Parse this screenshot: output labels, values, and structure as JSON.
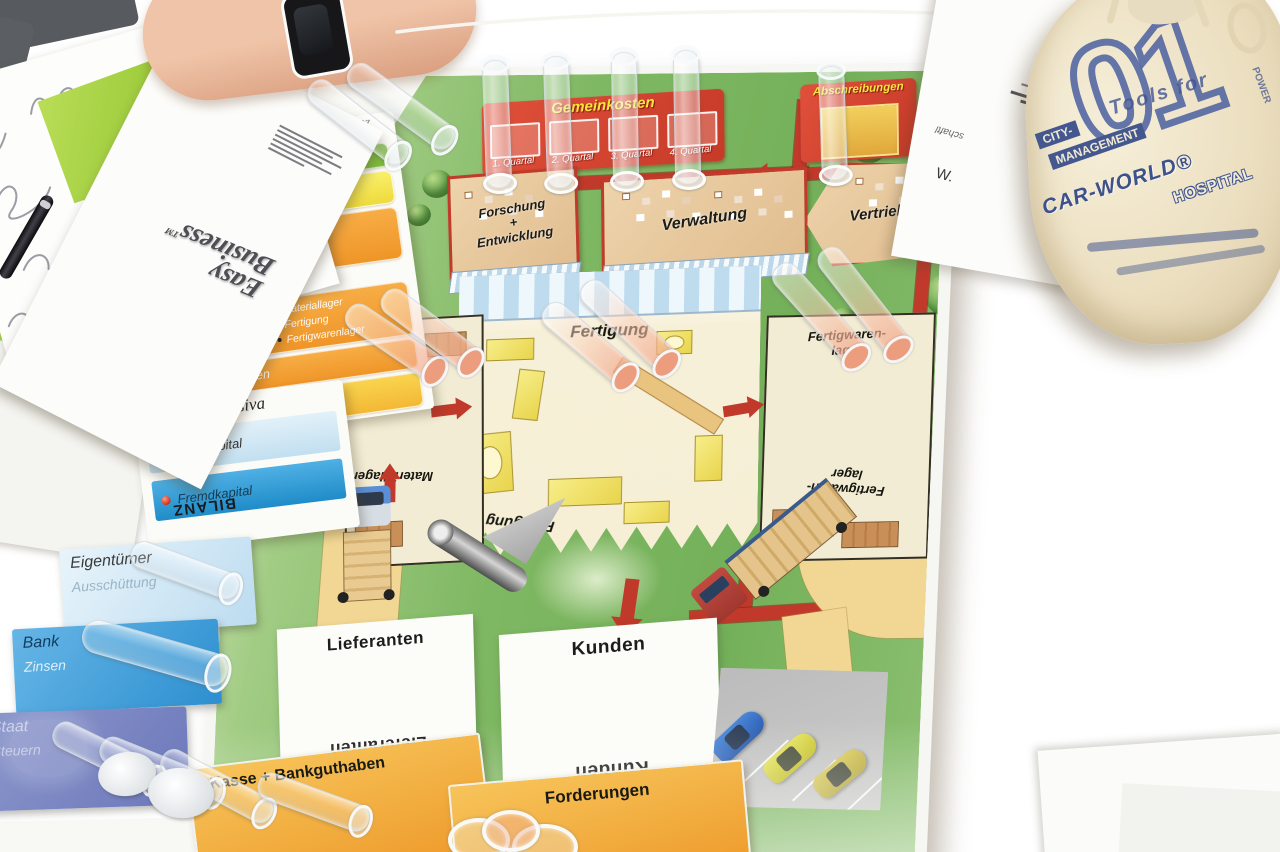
{
  "scene": {
    "description": "Photograph of the Easy Business board-game poster lying on a table with test tubes, balance-sheet cards, papers, a pen and a printed cloth bag"
  },
  "colors": {
    "board_green": "#7fb863",
    "road_red": "#c0392b",
    "road_yellow": "#f2d794",
    "panel_red": "#d84a32",
    "panel_orange": "#f0a030",
    "title_yellow": "#f8e63c",
    "bar_blue_light": "#cfe5f2",
    "bar_blue": "#2f9fd8",
    "bag_blue": "#44588f"
  },
  "poster": {
    "gemeinkosten": {
      "title": "Gemeinkosten",
      "slots": [
        "1. Quartal",
        "2. Quartal",
        "3. Quartal",
        "4. Quartal"
      ]
    },
    "abschreibungen": "Abschreibungen",
    "buildings": {
      "forschung_l1": "Forschung",
      "forschung_l2": "+",
      "forschung_l3": "Entwicklung",
      "verwaltung": "Verwaltung",
      "vertrieb": "Vertrieb"
    },
    "factory": {
      "title": "Fertigung",
      "bottom_label": "Fertigung",
      "material": "Materiallager",
      "fertigwaren_l1": "Fertigwaren-",
      "fertigwaren_l2": "lager"
    },
    "lieferanten": "Lieferanten",
    "kunden": "Kunden",
    "kasse": "Kasse + Bankguthaben",
    "forderungen": "Forderungen"
  },
  "aktiva_card": {
    "heading_l1": "Bilanz",
    "heading_l2": "Aktiva",
    "gebaeude": "und Gebäude",
    "maschinen": "Maschinen und Anlagen",
    "betriebs": "Betriebs- und Geschäfts- ausstattung",
    "umlauf": "Umlaufvermögen",
    "vorraete": "Vorräte",
    "vorraete_bullets": [
      "Materiallager",
      "Fertigung",
      "Fertigwarenlager"
    ],
    "forderungen": "Forderungen",
    "kasse": "Kasse + Bankguthaben"
  },
  "passiva_card": {
    "title": "Passiva",
    "eigenkapital": "Eigenkapital",
    "fremdkapital": "Fremdkapital",
    "bilanz": "BILANZ"
  },
  "stakeholders": {
    "eigentuemer": "Eigentümer",
    "ausschuettung": "Ausschüttung",
    "bank": "Bank",
    "zinsen": "Zinsen",
    "staat": "Staat",
    "steuern": "Steuern"
  },
  "booklet": {
    "logo_l1": "Easy",
    "logo_l2": "Business",
    "tm": "TM"
  },
  "bag": {
    "numeral": "01",
    "tools": "Tools for",
    "city": "CITY-",
    "management": "MANAGEMENT",
    "carworld": "CAR-WORLD®",
    "hospital": "HOSPITAL",
    "power": "POWER"
  },
  "paper_fragments": {
    "w": "W.",
    "schaft": "schaftl"
  }
}
